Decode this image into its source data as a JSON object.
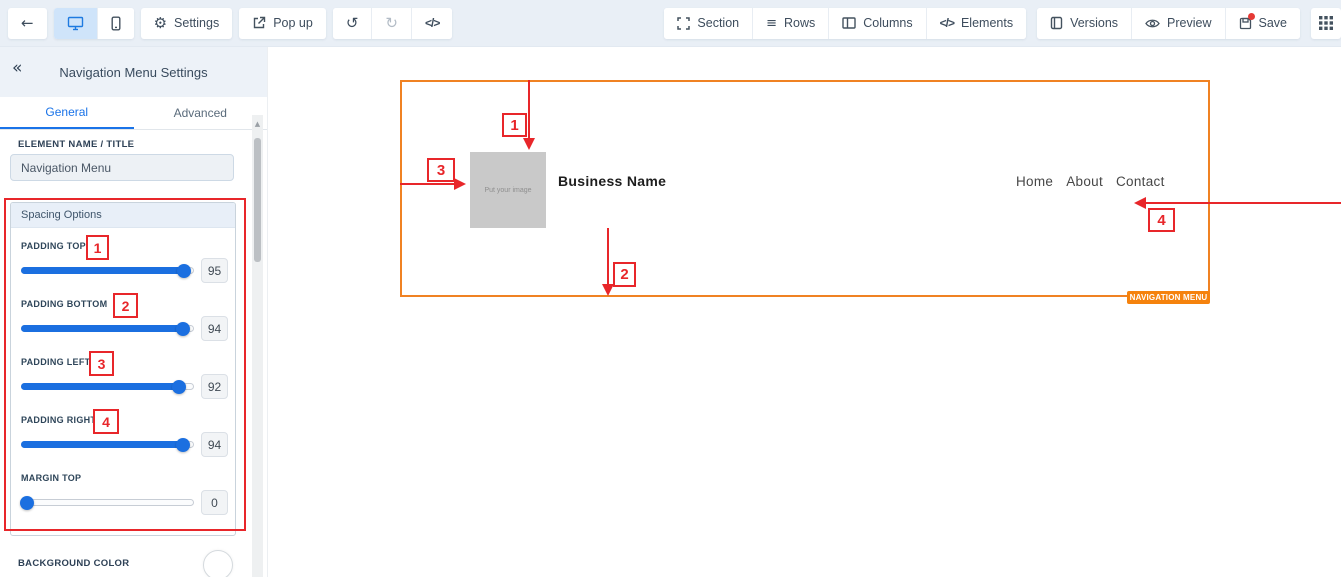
{
  "toolbar": {
    "back_icon": "←",
    "settings_label": "Settings",
    "popup_label": "Pop up",
    "undo_icon": "↺",
    "redo_icon": "↻",
    "code_icon": "</>",
    "gear_icon": "⚙",
    "section_label": "Section",
    "rows_label": "Rows",
    "rows_icon": "≡",
    "columns_label": "Columns",
    "elements_label": "Elements",
    "elements_icon": "</>",
    "versions_label": "Versions",
    "preview_label": "Preview",
    "save_label": "Save"
  },
  "sidebar": {
    "collapse_icon": "«",
    "title": "Navigation Menu Settings",
    "tabs": [
      {
        "label": "General",
        "active": true
      },
      {
        "label": "Advanced",
        "active": false
      }
    ],
    "element_name_label": "ELEMENT NAME / TITLE",
    "element_name_value": "Navigation Menu",
    "spacing": {
      "header": "Spacing Options",
      "sliders": [
        {
          "label": "PADDING TOP",
          "value": 95,
          "badge": "1"
        },
        {
          "label": "PADDING BOTTOM",
          "value": 94,
          "badge": "2"
        },
        {
          "label": "PADDING LEFT",
          "value": 92,
          "badge": "3"
        },
        {
          "label": "PADDING RIGHT",
          "value": 94,
          "badge": "4"
        },
        {
          "label": "MARGIN TOP",
          "value": 0
        }
      ]
    },
    "background_color_label": "BACKGROUND COLOR",
    "scroll_up_icon": "▲"
  },
  "canvas": {
    "logo_placeholder_text": "Put your image",
    "business_name": "Business Name",
    "nav_links": [
      "Home",
      "About",
      "Contact"
    ],
    "element_tag": "NAVIGATION MENU",
    "annotations": {
      "one": "1",
      "two": "2",
      "three": "3",
      "four": "4"
    }
  },
  "colors": {
    "accent_blue": "#1a73e8",
    "annotation_red": "#e8262a",
    "element_orange": "#f5861f",
    "toolbar_bg": "#e9eff6"
  }
}
